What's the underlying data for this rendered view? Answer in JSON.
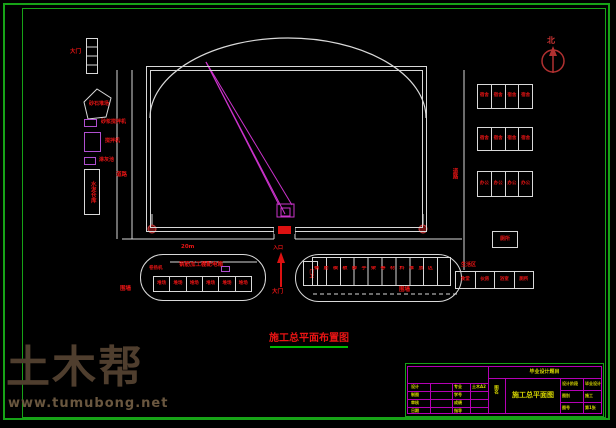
{
  "north_label": "北",
  "main_title": "施工总平面布置图",
  "watermark": {
    "brand": "土木帮",
    "url": "www.tumubong.net"
  },
  "labels": {
    "gate_top": "大门",
    "pentagon": "砂石堆场",
    "mortar_mixer": "砂浆搅拌机",
    "mixer": "搅拌机",
    "lime_pool": "淋灰池",
    "cement_store": "水泥仓库",
    "road_left": "道路",
    "road_right": "道路",
    "yard_dim": "20m",
    "yard_title": "钢筋加工棚配电箱",
    "winch": "卷扬机",
    "fence_left": "围墙",
    "fence_right": "围墙",
    "entry": "入口",
    "gate_main": "大门",
    "material_area": "钢筋模板脚手架等材料堆放区",
    "guard": "门卫",
    "toilet": "厕所",
    "living_area": "生活区"
  },
  "yard_cells": [
    "堆场",
    "堆场",
    "堆场",
    "堆场",
    "堆场",
    "堆场"
  ],
  "dorm_group1": [
    "宿舍",
    "宿舍",
    "宿舍",
    "宿舍"
  ],
  "dorm_group2": [
    "宿舍",
    "宿舍",
    "宿舍",
    "宿舍"
  ],
  "dorm_group3": [
    "办公",
    "办公",
    "办公",
    "办公"
  ],
  "canteen_row": [
    "食堂",
    "伙房",
    "浴室",
    "厕所"
  ],
  "titleblock": {
    "header": "毕业设计题目",
    "rows": [
      [
        "设计",
        "",
        "专业",
        "土木A2"
      ],
      [
        "制图",
        "",
        "学号",
        ""
      ],
      [
        "审核",
        "",
        "成绩",
        ""
      ],
      [
        "日期",
        "",
        "指导",
        ""
      ]
    ],
    "name_label": "图名",
    "drawing_name": "施工总平面图",
    "right_rows": [
      [
        "设计阶段",
        "毕业设计"
      ],
      [
        "图别",
        "施工"
      ],
      [
        "图号",
        "第1张"
      ]
    ]
  }
}
